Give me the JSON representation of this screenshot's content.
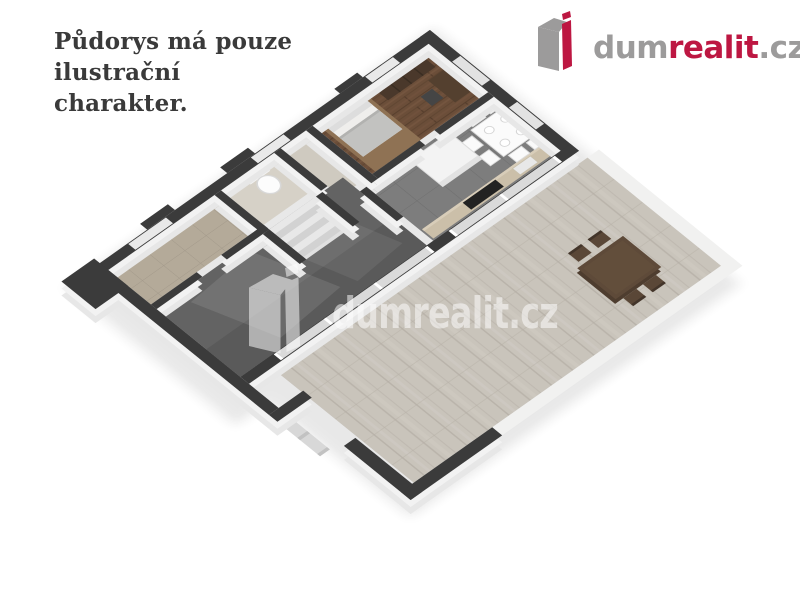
{
  "disclaimer": {
    "lines": [
      "Půdorys má pouze",
      "ilustrační",
      "charakter."
    ],
    "color": "#3a3a3a"
  },
  "brand": {
    "name": "dumrealit.cz",
    "segments": {
      "prefix": "dum",
      "accent": "realit",
      "suffix": ".cz"
    },
    "colors": {
      "gray": "#9c9b9b",
      "red": "#bd1742"
    },
    "icon": "building-3d-icon"
  },
  "watermark": {
    "text": "dumrealit.cz",
    "color": "#ffffff",
    "opacity": 0.52,
    "icon": "building-3d-icon"
  },
  "floor_plan": {
    "palette": {
      "background": "#ffffff",
      "wall_top": "#3b3b3b",
      "wall_face": "#efefef",
      "bedroom_wood_floor": "#6b4e39",
      "kitchen_tile_floor": "#7d7d7d",
      "living_room_floor": "#636363",
      "hallway_tile_floor": "#b4aa99",
      "bathroom_floor": "#d6d1c7",
      "terrace_deck": "#c9c4bb",
      "terrace_curb": "#f1f1f0",
      "furniture_wood_dark": "#5e4a39",
      "wardrobe_wood": "#4a382b",
      "cooktop_black": "#222222"
    }
  }
}
